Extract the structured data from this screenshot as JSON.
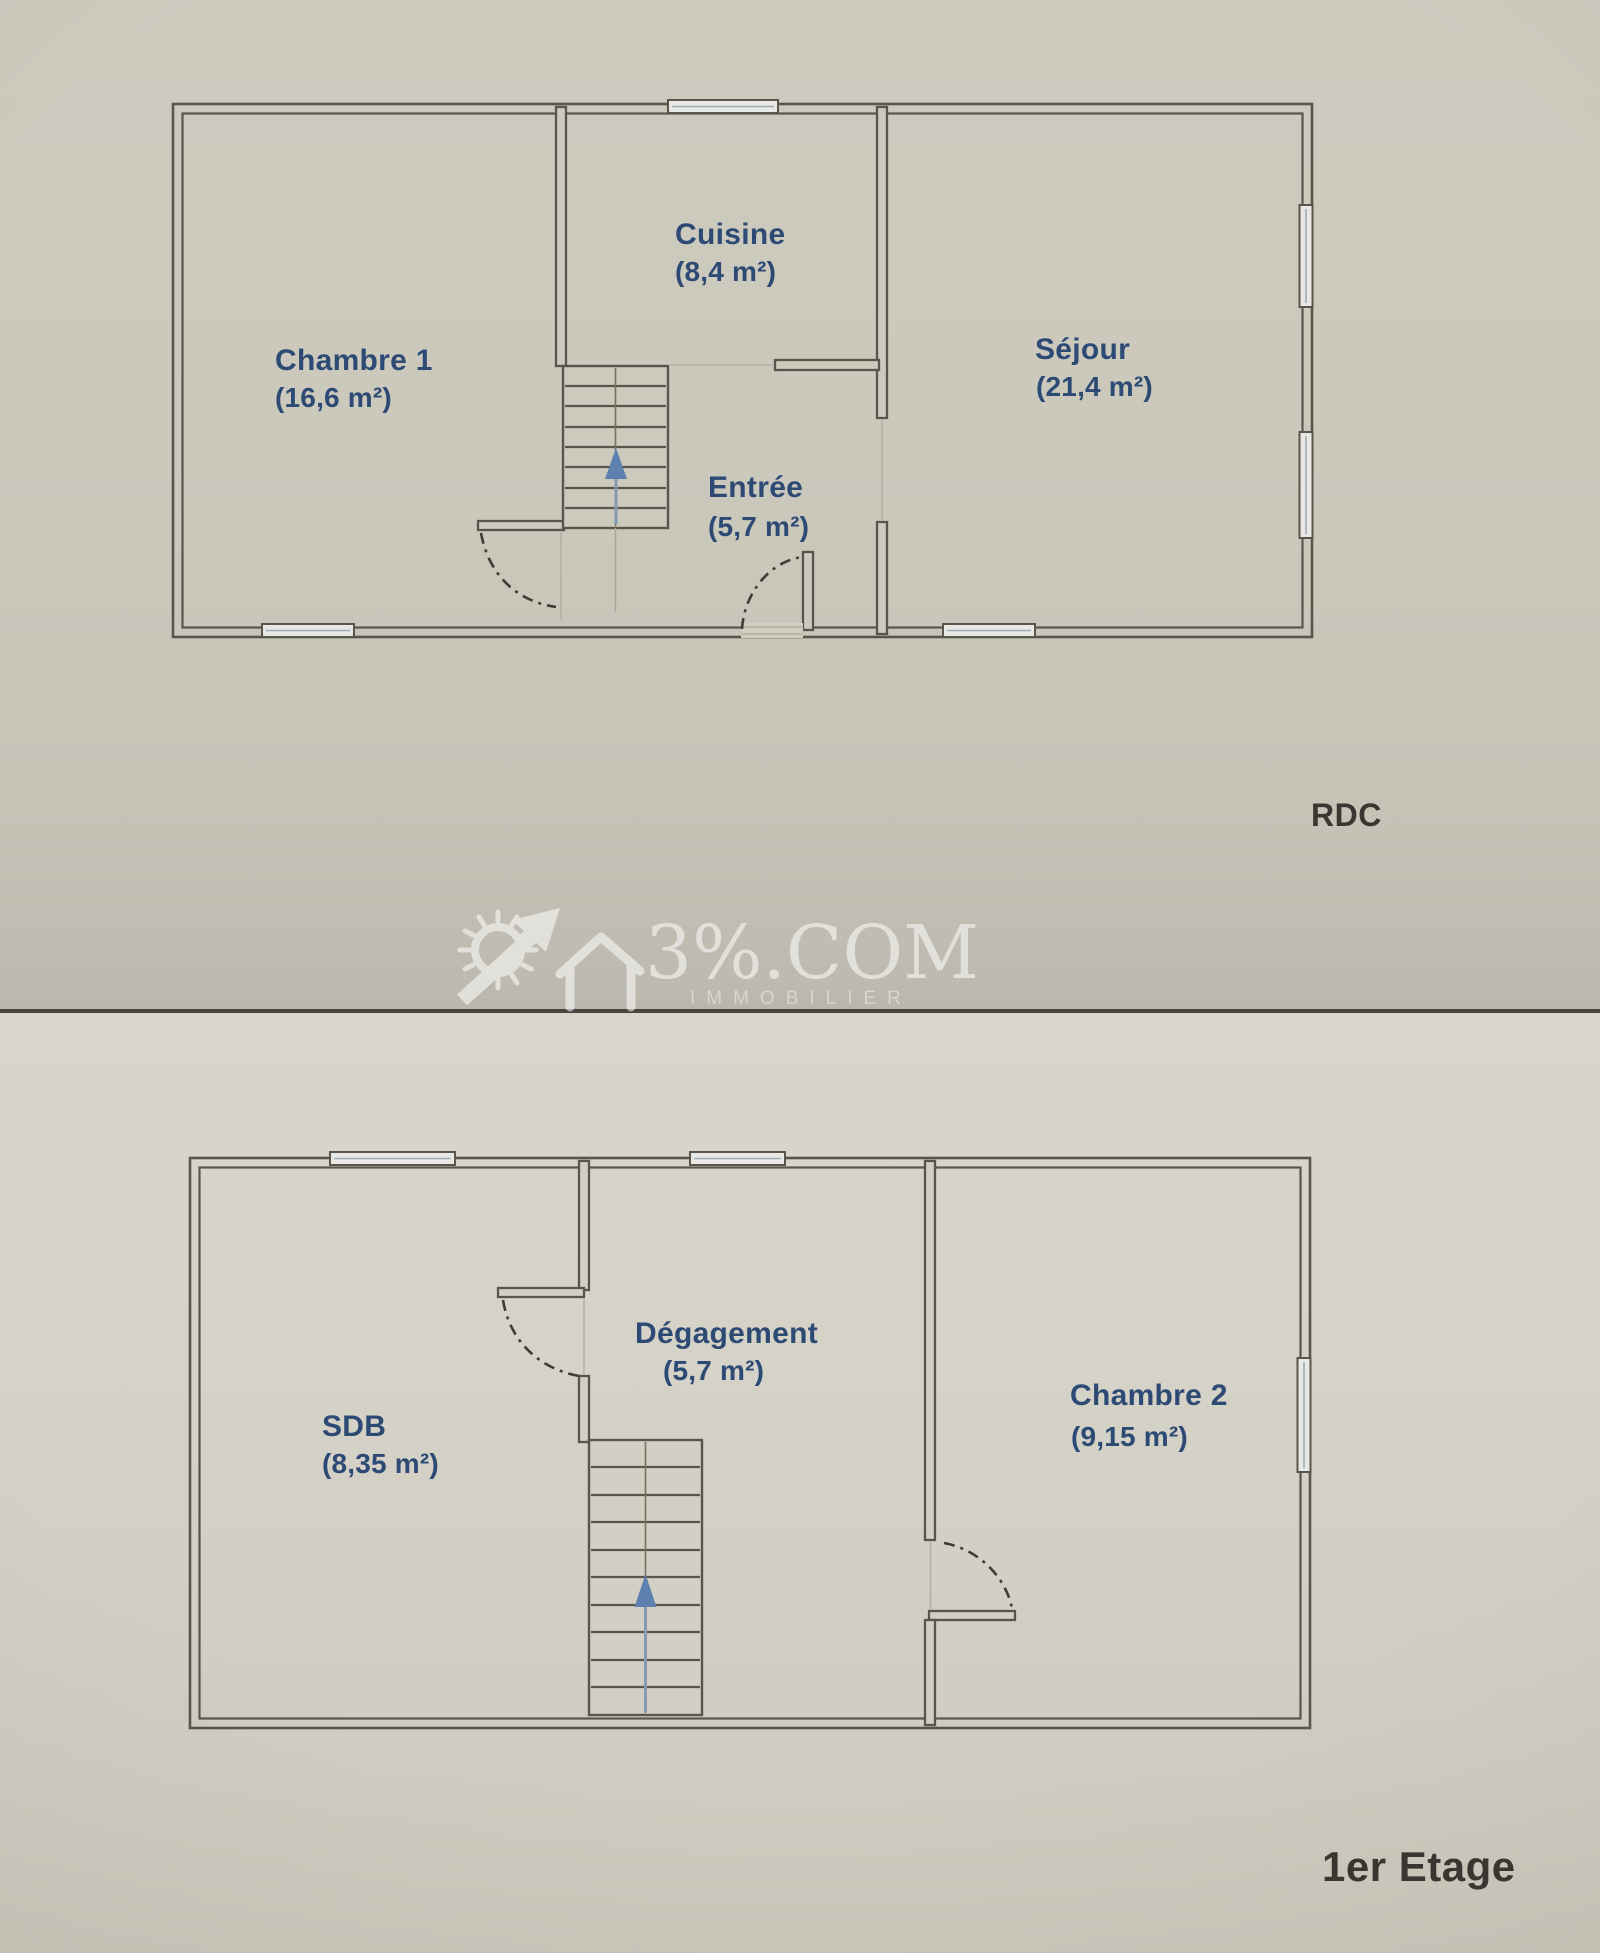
{
  "colors": {
    "wall": "#5a554c",
    "room_label": "#2d4a75",
    "floor_label": "#3a3732",
    "stair_arrow": "#5d80ae",
    "paper_top": "#cbc8bc",
    "paper_bottom": "#d5d2c7",
    "watermark": "#ffffff"
  },
  "floors": [
    {
      "label": "RDC",
      "rooms": [
        {
          "name": "Chambre 1",
          "area": "(16,6 m²)"
        },
        {
          "name": "Cuisine",
          "area": "(8,4 m²)"
        },
        {
          "name": "Entrée",
          "area": "(5,7 m²)"
        },
        {
          "name": "Séjour",
          "area": "(21,4 m²)"
        }
      ]
    },
    {
      "label": "1er Etage",
      "rooms": [
        {
          "name": "SDB",
          "area": "(8,35 m²)"
        },
        {
          "name": "Dégagement",
          "area": "(5,7 m²)"
        },
        {
          "name": "Chambre 2",
          "area": "(9,15 m²)"
        }
      ]
    }
  ],
  "watermark": {
    "brand": "3%.COM",
    "subtitle": "IMMOBILIER"
  }
}
